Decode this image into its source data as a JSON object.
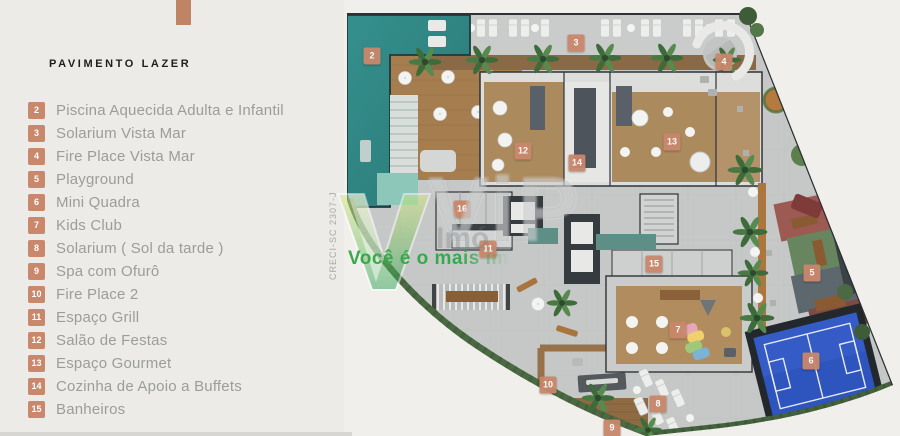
{
  "sidebar": {
    "title": "PAVIMENTO LAZER",
    "legend": [
      {
        "num": "2",
        "label": "Piscina Aquecida Adulta e Infantil"
      },
      {
        "num": "3",
        "label": "Solarium Vista Mar"
      },
      {
        "num": "4",
        "label": "Fire Place Vista Mar"
      },
      {
        "num": "5",
        "label": "Playground"
      },
      {
        "num": "6",
        "label": "Mini Quadra"
      },
      {
        "num": "7",
        "label": "Kids Club"
      },
      {
        "num": "8",
        "label": "Solarium ( Sol da tarde )"
      },
      {
        "num": "9",
        "label": "Spa com Ofurô"
      },
      {
        "num": "10",
        "label": "Fire Place 2"
      },
      {
        "num": "11",
        "label": "Espaço Grill"
      },
      {
        "num": "12",
        "label": "Salão de Festas"
      },
      {
        "num": "13",
        "label": "Espaço Gourmet"
      },
      {
        "num": "14",
        "label": "Cozinha de Apoio a Buffets"
      },
      {
        "num": "15",
        "label": "Banheiros"
      }
    ]
  },
  "plan": {
    "markers": [
      {
        "num": "2",
        "x": 372,
        "y": 56
      },
      {
        "num": "3",
        "x": 576,
        "y": 43
      },
      {
        "num": "4",
        "x": 724,
        "y": 62
      },
      {
        "num": "5",
        "x": 812,
        "y": 273
      },
      {
        "num": "6",
        "x": 811,
        "y": 361
      },
      {
        "num": "7",
        "x": 678,
        "y": 330
      },
      {
        "num": "8",
        "x": 658,
        "y": 404
      },
      {
        "num": "9",
        "x": 612,
        "y": 428
      },
      {
        "num": "10",
        "x": 548,
        "y": 385
      },
      {
        "num": "11",
        "x": 488,
        "y": 249
      },
      {
        "num": "12",
        "x": 523,
        "y": 151
      },
      {
        "num": "13",
        "x": 672,
        "y": 142
      },
      {
        "num": "14",
        "x": 577,
        "y": 163
      },
      {
        "num": "15",
        "x": 654,
        "y": 264
      },
      {
        "num": "16",
        "x": 462,
        "y": 209
      }
    ]
  },
  "watermark": {
    "brand": "ViP",
    "brand_fragment": "Imó",
    "tagline": "Você é o mais im",
    "license": "CRECI-SC 2307-J"
  },
  "colors": {
    "accent": "#C9876B",
    "pool_teal": "#2F8381",
    "court_blue": "#2E54BD",
    "hedge_green": "#4B6A43",
    "deck_wood": "#A57D4F",
    "paving_gray": "#C5C8C6",
    "panel_bg": "#ECEBE7",
    "canvas_bg": "#F0EFEC",
    "tagline_green": "#37A84C"
  }
}
